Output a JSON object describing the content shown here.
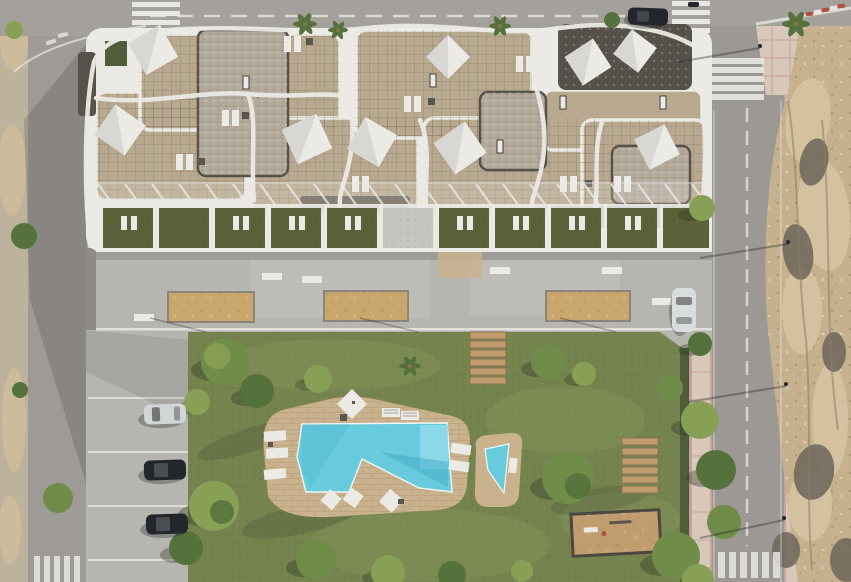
{
  "scene": {
    "title": "Aerial top-down 3D architectural render of an apartment complex with rooftop solariums, communal pool and gardens",
    "type": "architectural-visualization",
    "inventory": {
      "building": "apartment block with white curved balconies and rooftop terraces",
      "sail_shades": 9,
      "ground_floor_terraces": 10,
      "promenade_planters": 3,
      "promenade_benches": 6,
      "pools": 2,
      "wooden_step_sets": 2,
      "playground": 1,
      "parked_cars": 5,
      "crosswalks": 5,
      "parking_bays": 4
    }
  },
  "palette": {
    "asphalt": "#a4a19c",
    "asphalt_left": "#9e9b96",
    "road_right": "#9c9893",
    "marking": "#e9e7e2",
    "sidewalk_sand": "#bdb29c",
    "sand": "#ccbc9c",
    "dirt": "#c6b18e",
    "dirt_light": "#d6c4a2",
    "dirt_dark": "#a08f74",
    "rock": "#6e665a",
    "crevice": "#8d7f68",
    "pink_walk": "#c59a8e",
    "pink_tile": "#d8c8ba",
    "red_curb": "#b04f40",
    "lawn": "#75834e",
    "lawn_light": "#8a9760",
    "hedge": "#4f5e38",
    "terrace_grass": "#5c6139",
    "deck": "#c9b28d",
    "pool": "#68cbdd",
    "pool_light": "#92dcea",
    "pool_dark": "#3fa9c6",
    "roof_tile": "#b7a88f",
    "gravel_light": "#b3aa9b",
    "gravel_dark": "#57514b",
    "white": "#eceae5",
    "concrete": "#b7b5b0",
    "concrete_light": "#c6c4bf",
    "planter_sand": "#c9a66b",
    "wood": "#c09c6e",
    "wood_dark": "#8a7354",
    "tree_a": "#6f8c48",
    "tree_b": "#87a055",
    "tree_c": "#55713c",
    "tree_shadow": "#2c3522",
    "car_dark": "#23262b",
    "car_silver": "#d2d5d5",
    "car_white": "#dadddd",
    "table_dark": "#5a564f"
  }
}
